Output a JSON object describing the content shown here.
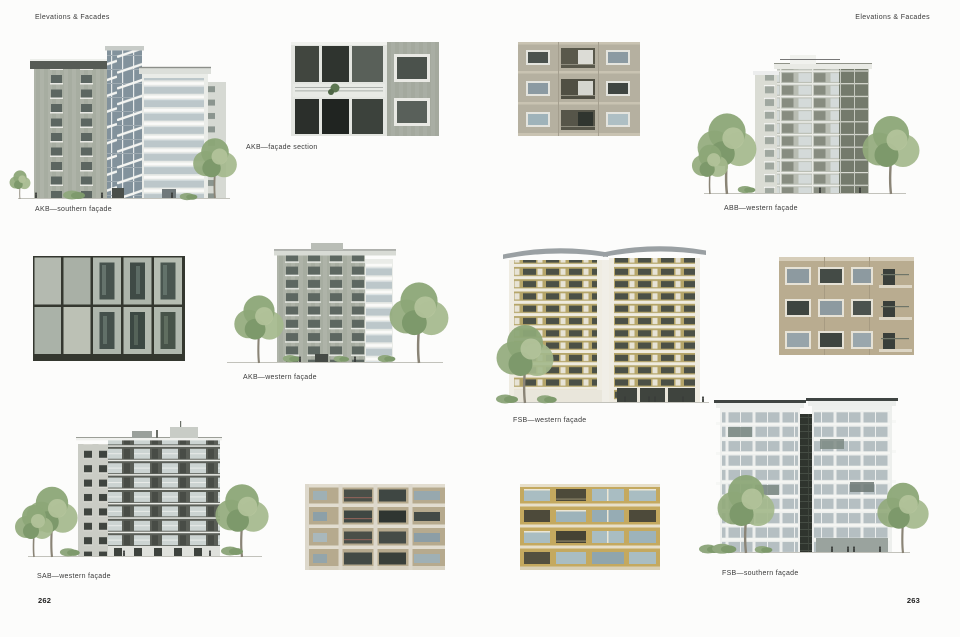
{
  "page": {
    "header_left": "Elevations & Facades",
    "header_right": "Elevations & Facades",
    "folio_left": "262",
    "folio_right": "263"
  },
  "captions": {
    "akb_southern": "AKB—southern façade",
    "akb_section": "AKB—façade section",
    "akb_western": "AKB—western façade",
    "sab_western": "SAB—western façade",
    "abb_western": "ABB—western façade",
    "fsb_western": "FSB—western façade",
    "fsb_southern": "FSB—southern façade"
  },
  "figures": [
    {
      "id": "akb-southern-elevation",
      "kind": "elevation-drawing",
      "caption_key": "akb_southern"
    },
    {
      "id": "akb-facade-section-photo",
      "kind": "photograph",
      "caption_key": "akb_section"
    },
    {
      "id": "facade-closeup-photo",
      "kind": "photograph",
      "caption_key": null
    },
    {
      "id": "akb-western-elevation",
      "kind": "elevation-drawing",
      "caption_key": "akb_western"
    },
    {
      "id": "sab-western-elevation",
      "kind": "elevation-drawing",
      "caption_key": "sab_western"
    },
    {
      "id": "beige-facade-photo",
      "kind": "photograph",
      "caption_key": null
    },
    {
      "id": "balcony-facade-photo",
      "kind": "photograph",
      "caption_key": null
    },
    {
      "id": "abb-western-elevation",
      "kind": "elevation-drawing",
      "caption_key": "abb_western"
    },
    {
      "id": "fsb-western-elevation",
      "kind": "elevation-drawing",
      "caption_key": "fsb_western"
    },
    {
      "id": "tan-facade-photo",
      "kind": "photograph",
      "caption_key": null
    },
    {
      "id": "yellow-brick-facade-photo",
      "kind": "photograph",
      "caption_key": null
    },
    {
      "id": "fsb-southern-elevation",
      "kind": "elevation-drawing",
      "caption_key": "fsb_southern"
    }
  ],
  "palette": {
    "paper": "#fcfcfb",
    "ink": "#3a3a3a",
    "stone_grey": "#aeb3a8",
    "dark_panel": "#5a5e57",
    "glass_blue": "#b9c4c8",
    "ochre_brick": "#b5a466",
    "yellow_brick": "#c4a95f",
    "tree_green": "#8ca677"
  }
}
